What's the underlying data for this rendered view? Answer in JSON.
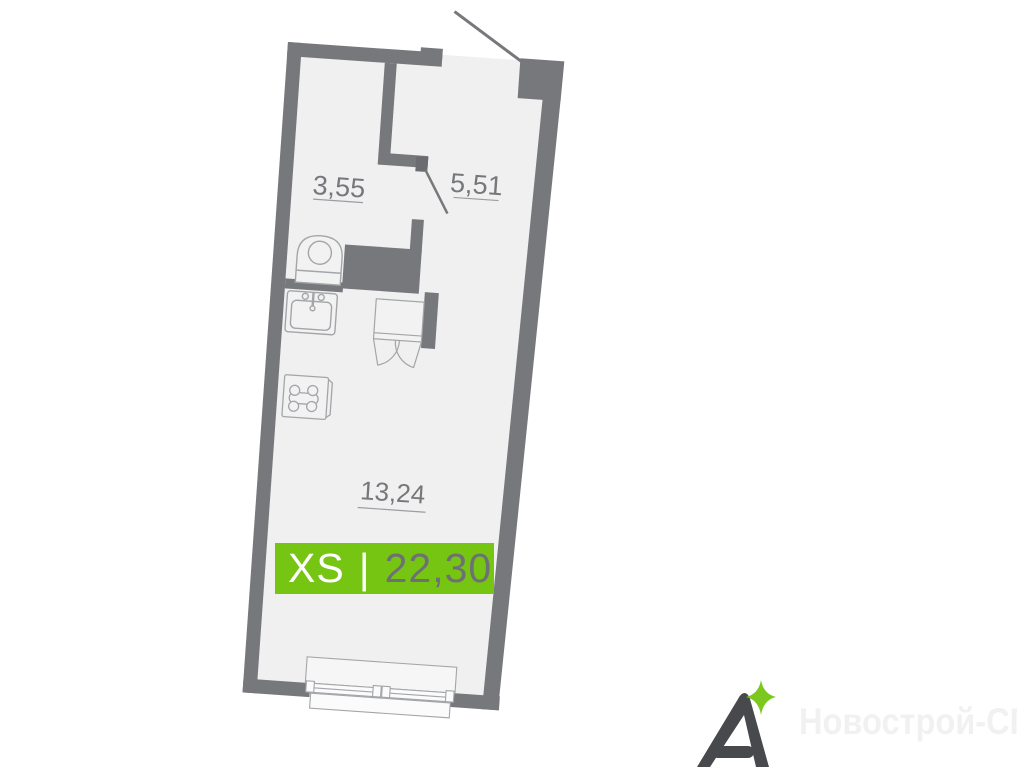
{
  "plan": {
    "room_labels": [
      {
        "id": "bathroom",
        "area": "3,55"
      },
      {
        "id": "hallway",
        "area": "5,51"
      },
      {
        "id": "living",
        "area": "13,24"
      }
    ],
    "badge": {
      "size_class": "XS",
      "separator": "|",
      "total_area": "22,30"
    }
  },
  "branding": {
    "logo_letter": "A",
    "watermark": "Новострой-СПб"
  },
  "colors": {
    "wall": "#76787b",
    "floor": "#f0f0f1",
    "fixture_line": "#a3a5a8",
    "label_text": "#75777a",
    "badge_green": "#76c513",
    "badge_area_text": "#6e7174",
    "logo_gray": "#47494c",
    "logo_star_green": "#7cc81e",
    "watermark_gray": "#f1f1f1"
  }
}
